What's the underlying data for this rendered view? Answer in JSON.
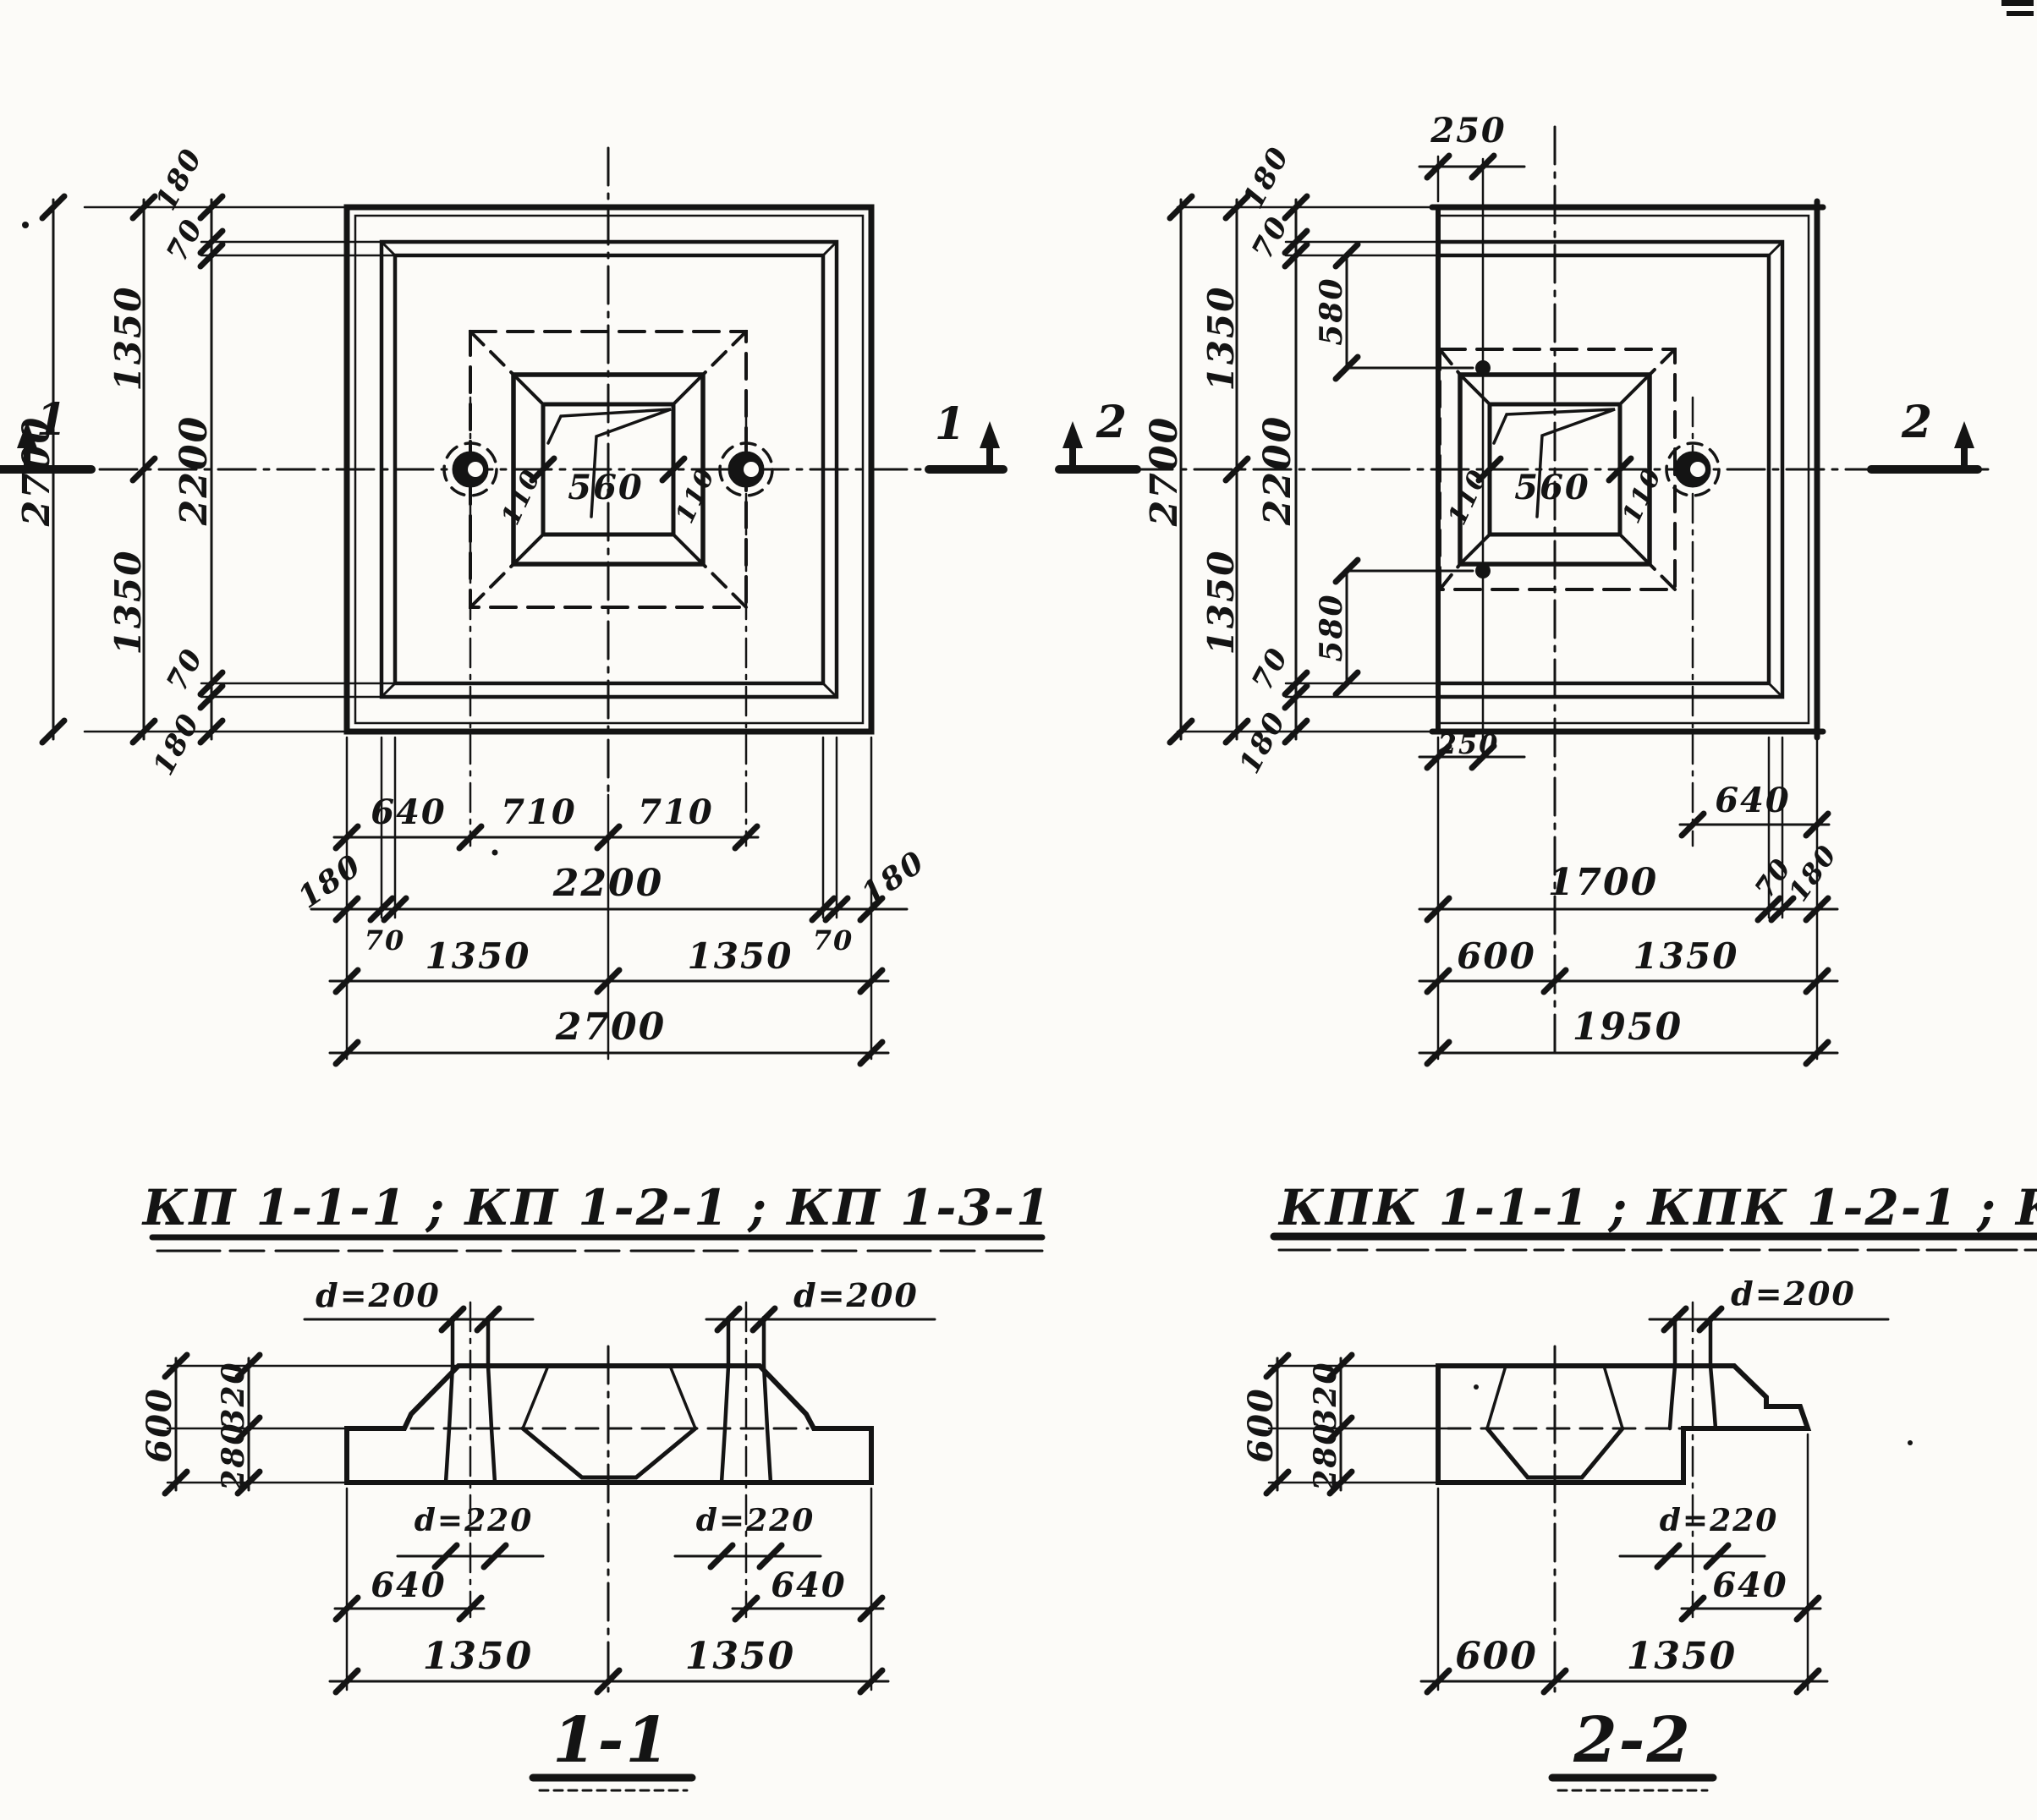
{
  "sheet": {
    "paper_color": "#fcfbf8",
    "ink_color": "#141414"
  },
  "titles": {
    "left": "КП 1-1-1 ; КП 1-2-1 ; КП 1-3-1",
    "right": "КПК 1-1-1 ; КПК 1-2-1 ; КПК 1-3-1"
  },
  "plan_left": {
    "marker_left": "1",
    "marker_right": "1",
    "v_total": "2700",
    "v_180_top": "180",
    "v_70_top": "70",
    "v_1350_top": "1350",
    "v_2200": "2200",
    "v_1350_bot": "1350",
    "v_70_bot": "70",
    "v_180_bot": "180",
    "c_110_l": "110",
    "c_560": "560",
    "c_110_r": "110",
    "b_640": "640",
    "b_710_l": "710",
    "b_710_r": "710",
    "b_180_l": "180",
    "b_2200": "2200",
    "b_180_r": "180",
    "b_70_l": "70",
    "b_70_r": "70",
    "b_1350_l": "1350",
    "b_1350_r": "1350",
    "b_total": "2700"
  },
  "plan_right": {
    "marker_left": "2",
    "marker_right": "2",
    "t_250": "250",
    "v_total": "2700",
    "v_180_top": "180",
    "v_70_top": "70",
    "v_580_top": "580",
    "v_1350_top": "1350",
    "v_2200": "2200",
    "v_1350_bot": "1350",
    "v_70_bot": "70",
    "v_580_bot": "580",
    "v_180_bot": "180",
    "c_110_l": "110",
    "c_560": "560",
    "c_110_r": "110",
    "b_250": "250",
    "b_640": "640",
    "b_1700": "1700",
    "b_70": "70",
    "b_180": "180",
    "b_600": "600",
    "b_1350": "1350",
    "b_total": "1950"
  },
  "section_1": {
    "title": "1-1",
    "d200_left": "d=200",
    "d200_right": "d=200",
    "d220_left": "d=220",
    "d220_right": "d=220",
    "v_600": "600",
    "v_320": "320",
    "v_280": "280",
    "b_640_l": "640",
    "b_640_r": "640",
    "b_1350_l": "1350",
    "b_1350_r": "1350"
  },
  "section_2": {
    "title": "2-2",
    "d200": "d=200",
    "d220": "d=220",
    "v_600": "600",
    "v_320": "320",
    "v_280": "280",
    "b_640": "640",
    "b_600": "600",
    "b_1350": "1350"
  }
}
